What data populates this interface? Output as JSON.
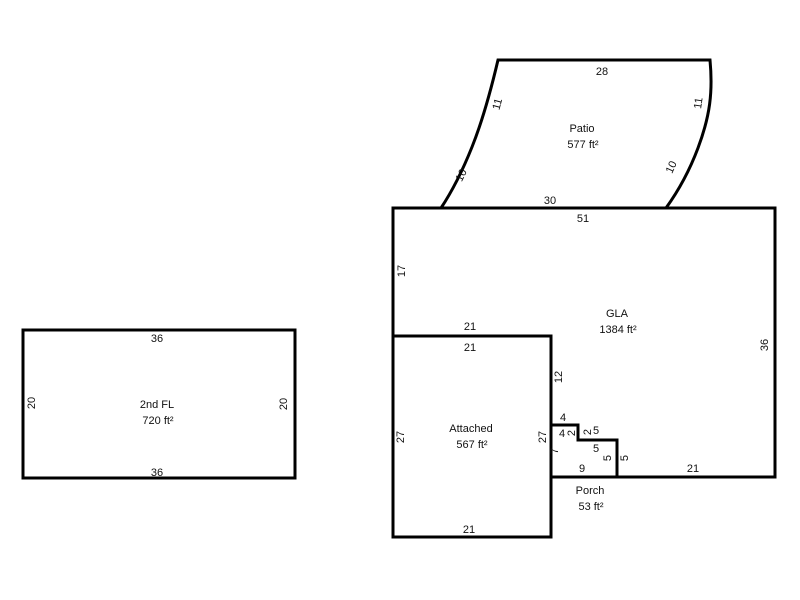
{
  "canvas": {
    "width": 800,
    "height": 600,
    "background": "#ffffff",
    "line_color": "#000000",
    "text_color": "#111111"
  },
  "shapes": [
    {
      "id": "patio",
      "name": "Patio",
      "area": "577 ft²",
      "label_x": 582,
      "label_y": 128,
      "path": "M 498,60 L 710,60 C 713,92 710,116 698,148 C 689,172 679,190 666,208 L 441,208 C 453,190 462,172 472,147 C 482,122 490,94 498,60 Z",
      "dims": [
        {
          "v": "28",
          "x": 602,
          "y": 71,
          "r": 0
        },
        {
          "v": "11",
          "x": 497,
          "y": 104,
          "r": -75
        },
        {
          "v": "10",
          "x": 461,
          "y": 175,
          "r": -63
        },
        {
          "v": "11",
          "x": 698,
          "y": 103,
          "r": -82
        },
        {
          "v": "10",
          "x": 671,
          "y": 167,
          "r": -66
        },
        {
          "v": "30",
          "x": 550,
          "y": 200,
          "r": 0
        }
      ]
    },
    {
      "id": "gla",
      "name": "GLA",
      "area": "1384 ft²",
      "label_x": 617,
      "label_y": 313,
      "path": "M 393,208 L 775,208 L 775,477 L 617,477 L 617,440 L 578,440 L 578,425 L 551,425 L 551,336 L 393,336 Z",
      "dims": [
        {
          "v": "51",
          "x": 583,
          "y": 218,
          "r": 0
        },
        {
          "v": "17",
          "x": 401,
          "y": 271,
          "r": -90
        },
        {
          "v": "36",
          "x": 764,
          "y": 345,
          "r": -90
        },
        {
          "v": "21",
          "x": 470,
          "y": 326,
          "r": 0
        },
        {
          "v": "12",
          "x": 558,
          "y": 377,
          "r": -90
        },
        {
          "v": "4",
          "x": 563,
          "y": 417,
          "r": 0
        },
        {
          "v": "2",
          "x": 587,
          "y": 432,
          "r": -90
        },
        {
          "v": "5",
          "x": 596,
          "y": 430,
          "r": 0
        },
        {
          "v": "5",
          "x": 624,
          "y": 458,
          "r": -90
        },
        {
          "v": "21",
          "x": 693,
          "y": 468,
          "r": 0
        }
      ]
    },
    {
      "id": "attached",
      "name": "Attached",
      "area": "567 ft²",
      "label_x": 471,
      "label_y": 428,
      "path": "M 393,336 L 551,336 L 551,537 L 393,537 Z",
      "dims": [
        {
          "v": "21",
          "x": 470,
          "y": 347,
          "r": 0
        },
        {
          "v": "27",
          "x": 400,
          "y": 437,
          "r": -90
        },
        {
          "v": "27",
          "x": 542,
          "y": 437,
          "r": -90
        },
        {
          "v": "21",
          "x": 469,
          "y": 529,
          "r": 0
        }
      ]
    },
    {
      "id": "porch",
      "name": "Porch",
      "area": "53 ft²",
      "label_x": 590,
      "label_y": 490,
      "path": "M 551,425 L 578,425 L 578,440 L 617,440 L 617,477 L 551,477 Z",
      "dims": [
        {
          "v": "4",
          "x": 562,
          "y": 433,
          "r": 0
        },
        {
          "v": "2",
          "x": 571,
          "y": 433,
          "r": -90
        },
        {
          "v": "5",
          "x": 596,
          "y": 448,
          "r": 0
        },
        {
          "v": "5",
          "x": 607,
          "y": 458,
          "r": -90
        },
        {
          "v": "7",
          "x": 554,
          "y": 451,
          "r": -90
        },
        {
          "v": "9",
          "x": 582,
          "y": 468,
          "r": 0
        }
      ]
    },
    {
      "id": "second-floor",
      "name": "2nd FL",
      "area": "720 ft²",
      "label_x": 157,
      "label_y": 404,
      "path": "M 23,330 L 295,330 L 295,478 L 23,478 Z",
      "dims": [
        {
          "v": "36",
          "x": 157,
          "y": 338,
          "r": 0
        },
        {
          "v": "20",
          "x": 31,
          "y": 403,
          "r": -90
        },
        {
          "v": "20",
          "x": 283,
          "y": 404,
          "r": -90
        },
        {
          "v": "36",
          "x": 157,
          "y": 472,
          "r": 0
        }
      ]
    }
  ]
}
